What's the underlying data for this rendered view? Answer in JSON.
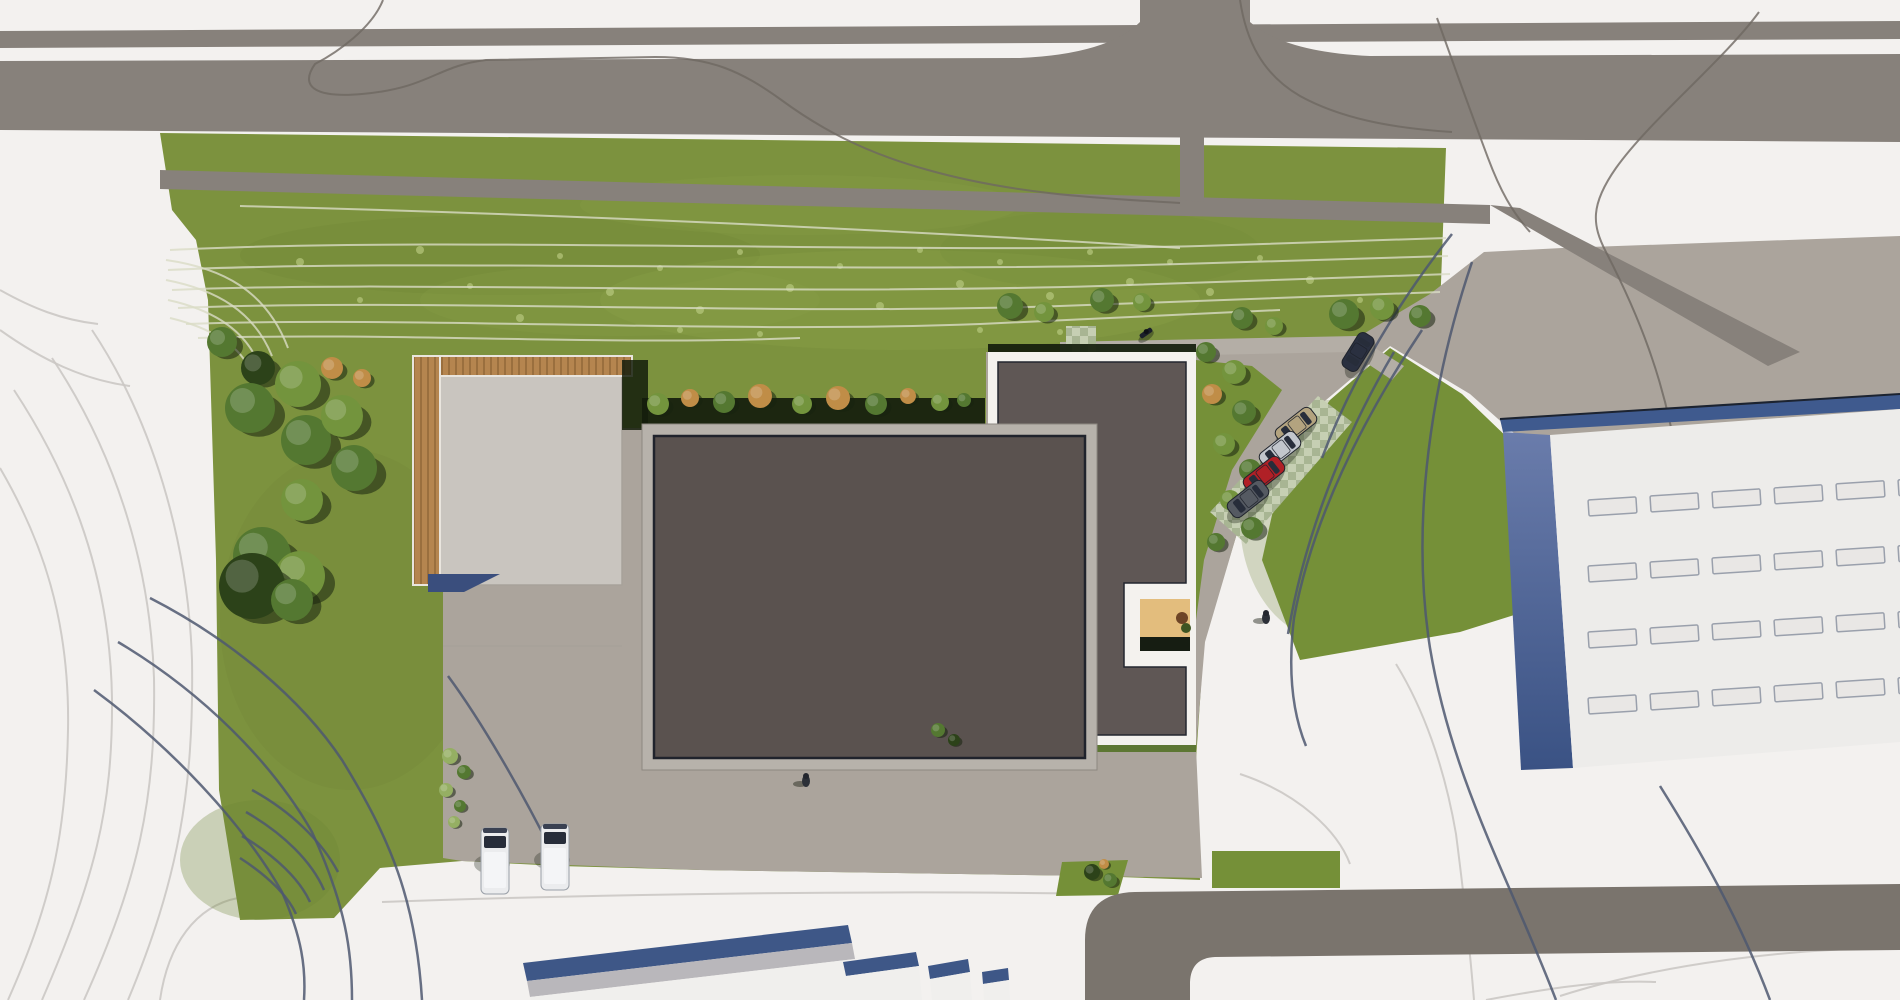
{
  "palette": {
    "bg": "#f3f1ef",
    "road": "#87817b",
    "roadDark": "#7a746d",
    "apron": "#aba49c",
    "walkway": "#b4aea6",
    "concrete": "#c9c5bf",
    "grass": "#7c923e",
    "grassStrip": "#759038",
    "mottleDark": "#6c8335",
    "mottleLight": "#8ea64c",
    "speck": "#b7c77e",
    "contourGrass": "#dadcc6",
    "contourWhite": "#cbc8c4",
    "contourDark": "#4e5870",
    "contourRoad": "#6e6862",
    "roofMain": "#5a524f",
    "roofAnnex": "#5f5755",
    "roofOutline": "#20232c",
    "parapet": "#b7b2ab",
    "borderWhite": "#f4f2ee",
    "wood": "#b5854f",
    "woodDark": "#9a6f3e",
    "deck": "#e3bd7d",
    "deckShadow": "#161d12",
    "hedge": "#141d0c",
    "blueShadow": "#3a4e7d",
    "fascia": "#3f5a8e",
    "wallLight": "#6a7cab",
    "wallDark": "#3a5284",
    "bigRoof": "#edecea",
    "skylightFill": "#e9e7e5",
    "skylightStroke": "#9aa0ac",
    "gableBlue": "#3e5787",
    "gableGray": "#b9b7bb",
    "buildingWhite": "#f0efed",
    "paverA": "#c6cfb3",
    "paverB": "#a8b593",
    "glass": "#272d3a",
    "vanWhite": "#ebecee",
    "person": "#23262e",
    "treeShadow": "#17230e",
    "tree_d": "#2c4219",
    "tree_m": "#547831",
    "tree_l": "#73943d",
    "tree_p": "#95af63",
    "tree_t": "#c08d47",
    "carBeige": "#b3a37f",
    "carSilver": "#c2c6cc",
    "carRed": "#b02026",
    "carGray": "#555a62",
    "carNavy": "#2a3040"
  },
  "scene": {
    "contours": {
      "white": [
        "M92,330 C152,420 188,540 192,660 C194,790 178,880 128,1000",
        "M52,358 C112,448 150,558 154,678 C156,800 138,880 84,1000",
        "M14,390 C72,478 110,578 112,698 C113,810 94,880 42,1000",
        "M0,468 C42,540 70,620 68,730 C66,842 48,910 8,1000",
        "M0,330 C42,360 84,380 130,386",
        "M0,290 C32,308 62,320 98,324",
        "M160,1000 C168,944 196,906 238,898",
        "M382,902 C600,894 880,890 1108,894",
        "M1240,774 C1300,794 1338,832 1350,864",
        "M1396,664 C1422,706 1444,764 1456,834 C1464,896 1470,950 1474,1000",
        "M1560,996 C1660,964 1790,948 1900,948",
        "M1486,1000 C1560,986 1610,980 1656,982"
      ],
      "road": [
        "M383,0 C372,28 338,52 315,64 C298,88 318,98 362,94 C430,88 436,66 486,60 L655,57 C712,57 742,72 780,99 C818,127 862,152 928,170 C1010,193 1090,198 1180,203",
        "M1240,0 C1246,40 1262,74 1300,96 C1340,118 1390,128 1452,132",
        "M1759,12 C1724,60 1650,120 1616,168 C1590,205 1592,225 1606,252 C1636,310 1666,380 1678,468 C1688,560 1698,640 1708,716",
        "M1437,18 C1452,60 1470,110 1488,158 C1500,190 1512,212 1530,232"
      ],
      "grass": [
        "M170,250 C430,236 900,254 1200,246 C1300,243 1390,240 1446,238",
        "M168,270 C420,258 860,274 1180,264 C1300,260 1400,257 1448,256",
        "M172,290 C400,280 760,296 1100,286 C1260,281 1380,276 1450,274",
        "M178,308 C420,298 780,316 1060,306 C1200,301 1330,296 1440,292",
        "M186,324 C420,316 720,334 980,324 C1100,319 1200,314 1280,310",
        "M198,338 C400,332 600,346 800,338",
        "M166,260 C222,268 266,290 288,348",
        "M166,280 C218,290 254,312 272,356",
        "M168,300 C214,310 244,330 258,362",
        "M170,318 C212,328 238,346 248,366",
        "M240,206 C560,214 900,230 1180,248"
      ],
      "dark": [
        "M1472,262 C1432,380 1410,520 1430,648 C1452,780 1510,880 1556,1000",
        "M1660,786 C1700,850 1740,920 1770,1000",
        "M1422,330 C1362,420 1312,520 1294,618 C1288,668 1292,712 1306,746",
        "M1394,352 C1342,440 1304,538 1288,634",
        "M1452,234 C1400,300 1352,378 1322,458",
        "M150,598 C232,640 302,700 342,760 C390,838 416,900 422,1000",
        "M118,642 C202,692 272,762 312,832 C346,906 352,952 352,1000",
        "M94,690 C170,746 242,822 282,892 C302,938 306,968 304,1000",
        "M252,790 C292,812 322,842 338,872",
        "M246,812 C284,834 312,862 324,890",
        "M242,836 C276,856 300,880 310,902",
        "M240,858 C268,876 288,896 296,914",
        "M448,676 C482,722 522,792 550,848"
      ]
    },
    "mottle": [
      [
        500,
        255,
        260,
        40,
        "mottleDark",
        0.25
      ],
      [
        900,
        300,
        300,
        50,
        "mottleLight",
        0.25
      ],
      [
        350,
        620,
        130,
        170,
        "mottleDark",
        0.2
      ],
      [
        800,
        205,
        220,
        30,
        "mottleLight",
        0.2
      ],
      [
        1330,
        520,
        90,
        120,
        "mottleDark",
        0.25
      ],
      [
        260,
        860,
        80,
        60,
        "mottleDark",
        0.3
      ],
      [
        620,
        300,
        200,
        36,
        "mottleLight",
        0.2
      ],
      [
        1100,
        250,
        160,
        40,
        "mottleDark",
        0.15
      ]
    ],
    "specks": [
      [
        300,
        262,
        4
      ],
      [
        360,
        300,
        3
      ],
      [
        420,
        250,
        4
      ],
      [
        470,
        286,
        3
      ],
      [
        520,
        318,
        4
      ],
      [
        560,
        256,
        3
      ],
      [
        610,
        292,
        4
      ],
      [
        660,
        268,
        3
      ],
      [
        700,
        310,
        4
      ],
      [
        740,
        252,
        3
      ],
      [
        790,
        288,
        4
      ],
      [
        840,
        266,
        3
      ],
      [
        880,
        306,
        4
      ],
      [
        920,
        250,
        3
      ],
      [
        960,
        284,
        4
      ],
      [
        1000,
        262,
        3
      ],
      [
        1050,
        296,
        4
      ],
      [
        1090,
        252,
        3
      ],
      [
        1130,
        282,
        4
      ],
      [
        1170,
        262,
        3
      ],
      [
        1210,
        292,
        4
      ],
      [
        1260,
        258,
        3
      ],
      [
        1310,
        280,
        4
      ],
      [
        1360,
        300,
        3
      ],
      [
        680,
        330,
        3
      ],
      [
        760,
        334,
        3
      ],
      [
        980,
        330,
        3
      ],
      [
        1060,
        332,
        3
      ]
    ],
    "trees": [
      [
        222,
        342,
        15,
        "m"
      ],
      [
        258,
        368,
        17,
        "d"
      ],
      [
        250,
        408,
        25,
        "m"
      ],
      [
        298,
        384,
        23,
        "l"
      ],
      [
        332,
        368,
        11,
        "t"
      ],
      [
        362,
        378,
        9,
        "t"
      ],
      [
        306,
        440,
        25,
        "m"
      ],
      [
        342,
        416,
        21,
        "l"
      ],
      [
        354,
        468,
        23,
        "m"
      ],
      [
        302,
        500,
        21,
        "l"
      ],
      [
        262,
        556,
        29,
        "m"
      ],
      [
        300,
        576,
        25,
        "l"
      ],
      [
        252,
        586,
        33,
        "d"
      ],
      [
        292,
        600,
        21,
        "m"
      ],
      [
        658,
        404,
        11,
        "l"
      ],
      [
        690,
        398,
        9,
        "t"
      ],
      [
        724,
        402,
        11,
        "m"
      ],
      [
        760,
        396,
        12,
        "t"
      ],
      [
        802,
        404,
        10,
        "l"
      ],
      [
        838,
        398,
        12,
        "t"
      ],
      [
        876,
        404,
        11,
        "m"
      ],
      [
        908,
        396,
        8,
        "t"
      ],
      [
        940,
        402,
        9,
        "l"
      ],
      [
        964,
        400,
        7,
        "m"
      ],
      [
        1010,
        306,
        13,
        "m"
      ],
      [
        1044,
        312,
        10,
        "l"
      ],
      [
        1102,
        300,
        12,
        "m"
      ],
      [
        1142,
        302,
        9,
        "l"
      ],
      [
        1242,
        318,
        11,
        "m"
      ],
      [
        1274,
        326,
        9,
        "l"
      ],
      [
        1206,
        352,
        10,
        "m"
      ],
      [
        1234,
        372,
        12,
        "l"
      ],
      [
        1212,
        394,
        10,
        "t"
      ],
      [
        1244,
        412,
        12,
        "m"
      ],
      [
        1224,
        444,
        11,
        "l"
      ],
      [
        1250,
        470,
        11,
        "m"
      ],
      [
        1230,
        500,
        10,
        "l"
      ],
      [
        1252,
        528,
        11,
        "m"
      ],
      [
        1216,
        542,
        9,
        "m"
      ],
      [
        1344,
        314,
        15,
        "m"
      ],
      [
        1382,
        308,
        12,
        "l"
      ],
      [
        1420,
        316,
        11,
        "m"
      ],
      [
        450,
        756,
        8,
        "p"
      ],
      [
        464,
        772,
        7,
        "m"
      ],
      [
        446,
        790,
        7,
        "p"
      ],
      [
        460,
        806,
        6,
        "m"
      ],
      [
        454,
        822,
        6,
        "p"
      ],
      [
        1092,
        872,
        8,
        "d"
      ],
      [
        1110,
        880,
        7,
        "m"
      ],
      [
        1104,
        864,
        5,
        "t"
      ],
      [
        938,
        730,
        7,
        "m"
      ],
      [
        954,
        740,
        6,
        "d"
      ]
    ],
    "cars": [
      [
        1296,
        426,
        -38,
        "carBeige",
        44,
        19
      ],
      [
        1280,
        450,
        -38,
        "carSilver",
        44,
        19
      ],
      [
        1264,
        475,
        -38,
        "carRed",
        44,
        19
      ],
      [
        1248,
        499,
        -38,
        "carGray",
        44,
        19
      ],
      [
        1358,
        352,
        -58,
        "carNavy",
        40,
        18
      ]
    ],
    "vans": [
      [
        495,
        828
      ],
      [
        555,
        824
      ]
    ],
    "people": [
      [
        806,
        779
      ],
      [
        1266,
        616
      ]
    ],
    "moto": [
      1146,
      333,
      -35
    ],
    "skylights": {
      "rows": 4,
      "cols": 6,
      "x0": 1588,
      "y0": 500,
      "dx": 62,
      "dy": 66,
      "slope": -0.065,
      "w": 48,
      "h": 16,
      "tilt": -3.7
    }
  }
}
